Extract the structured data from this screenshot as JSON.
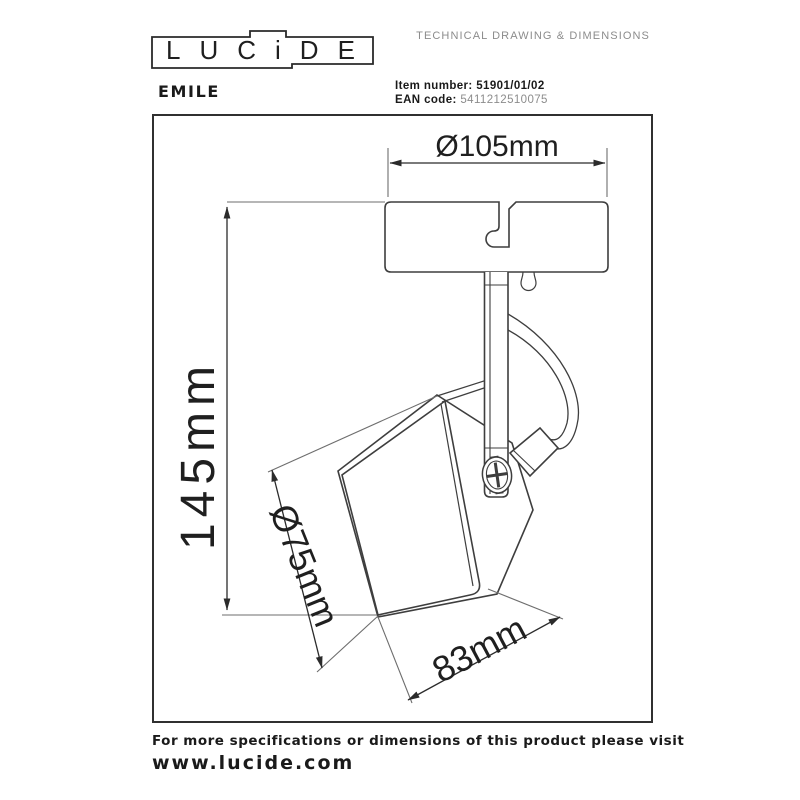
{
  "brand": {
    "logo_text": "LUCiDE"
  },
  "header": {
    "doc_type": "TECHNICAL DRAWING & DIMENSIONS",
    "product_name": "EMILE",
    "item_number_label": "Item number:",
    "item_number_value": "51901/01/02",
    "ean_label": "EAN code:",
    "ean_value": "5411212510075"
  },
  "drawing": {
    "dim_top_diameter": "Ø105mm",
    "dim_height": "145mm",
    "dim_head_diameter": "Ø75mm",
    "dim_head_width": "83mm"
  },
  "footer": {
    "info_line": "For more specifications or dimensions of this product please visit",
    "website": "www.lucide.com"
  },
  "colors": {
    "line": "#3e3e3e",
    "dim_line": "#2b2b2b",
    "muted": "#8c8c8c",
    "text": "#1a1a1a"
  }
}
